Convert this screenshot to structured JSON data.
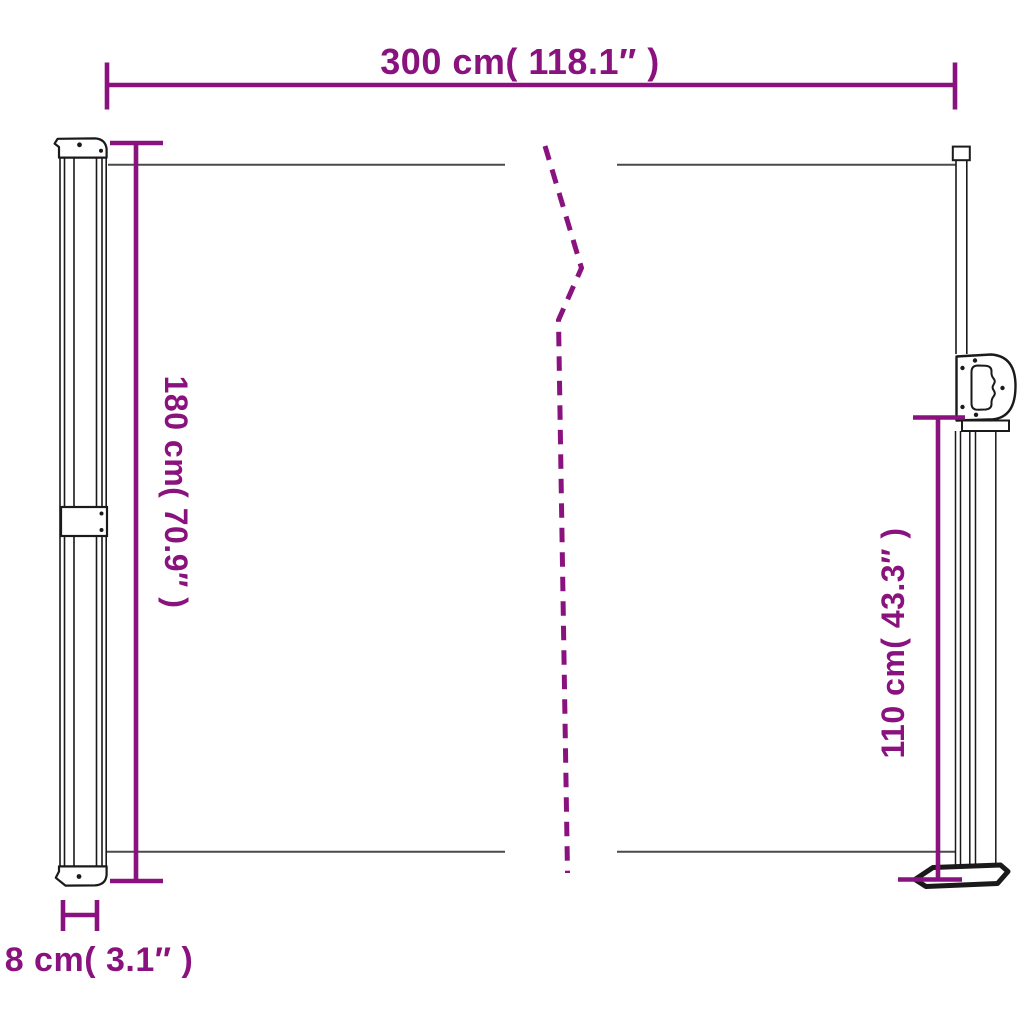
{
  "colors": {
    "dimension": "#8A127E",
    "outline": "#1A1A1A",
    "panel_edge": "#4A4A4A",
    "background": "#FFFFFF"
  },
  "labels": {
    "width": "300 cm( 118.1″ )",
    "height": "180 cm( 70.9″ )",
    "pole_height": "110 cm( 43.3″ )",
    "depth": "8 cm( 3.1″ )"
  }
}
